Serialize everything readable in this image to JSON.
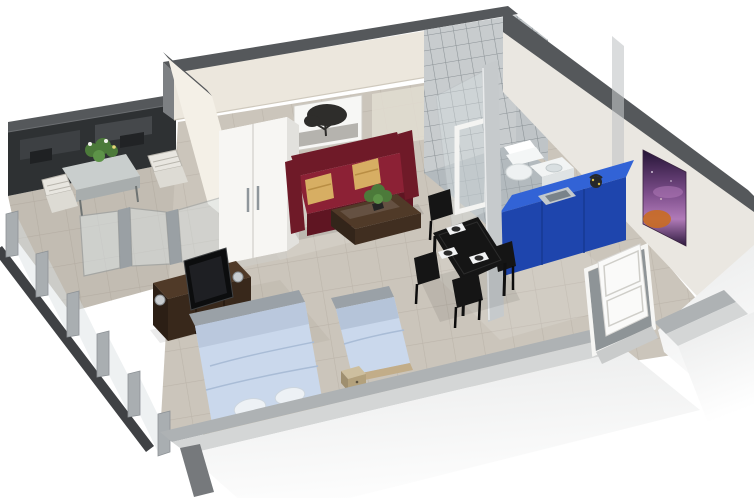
{
  "scene": {
    "title": "3D isometric floor plan of a studio apartment",
    "rooms": [
      {
        "name": "balcony",
        "furniture": [
          "outdoor-dining-table",
          "flower-centerpiece",
          "outdoor-chair-left",
          "outdoor-chair-right",
          "glass-railing",
          "dark-facade-wall"
        ]
      },
      {
        "name": "living-area",
        "furniture": [
          "wardrobe",
          "sofa-bed",
          "cushion-left",
          "cushion-right",
          "coffee-table",
          "table-plant",
          "tree-wall-picture",
          "sliding-glass-door"
        ]
      },
      {
        "name": "kitchen",
        "furniture": [
          "blue-kitchen-counter",
          "sink",
          "kettle"
        ]
      },
      {
        "name": "dining-area",
        "furniture": [
          "dining-table",
          "place-settings",
          "dining-chairs"
        ]
      },
      {
        "name": "bathroom",
        "furniture": [
          "glass-block-wall",
          "shower-enclosure",
          "toilet",
          "washbasin-vanity"
        ]
      },
      {
        "name": "sleeping-area",
        "furniture": [
          "double-bed",
          "single-bed",
          "nightstands",
          "tv-sideboard",
          "flat-tv",
          "silver-lamps"
        ]
      },
      {
        "name": "entrance",
        "furniture": [
          "entry-door",
          "abstract-wall-art"
        ]
      }
    ],
    "counts": {
      "beds": 2,
      "sofas": 1,
      "dining_place_settings": 3,
      "balcony_chairs": 2
    }
  },
  "colors": {
    "wall_top": "#55585b",
    "wall_cream": "#ece7dd",
    "wall_right": "#eae7e1",
    "wall_divider": "#f4f0e7",
    "balcony_wall": "#2e3133",
    "floor": "#cbc5bb",
    "balcony_floor": "#c2bcb2",
    "tile": "#c8ccce",
    "bath_floor": "#b3babe",
    "glass": "#d9e1e3",
    "frame": "#9aa0a4",
    "sofa": "#8c2135",
    "sofa_dark": "#6f1a28",
    "sofa_deep": "#5f1522",
    "pillow": "#d7ae63",
    "wood": "#38281b",
    "wood_top": "#503a28",
    "wardrobe": "#f7f6f3",
    "kitchen_top": "#3263d6",
    "kitchen_front": "#1e45ad",
    "steel": "#c3c9cd",
    "dining": "#151515",
    "plate": "#f2f3f4",
    "bed": "#cad8ec",
    "bed_blanket": "#b5c4d9",
    "bed_head": "#9aa1a7",
    "bed_base": "#c2ad89",
    "plant": "#4c7a3a",
    "plant_light": "#5d9348",
    "door": "#fafaf9",
    "front_inner": "#aeb2b4",
    "front_top": "#d4d6d6",
    "art_top": "#241436",
    "art_mid": "#7c4d8a",
    "art_glow": "#b07ab8",
    "art_orange": "#c96b22"
  }
}
